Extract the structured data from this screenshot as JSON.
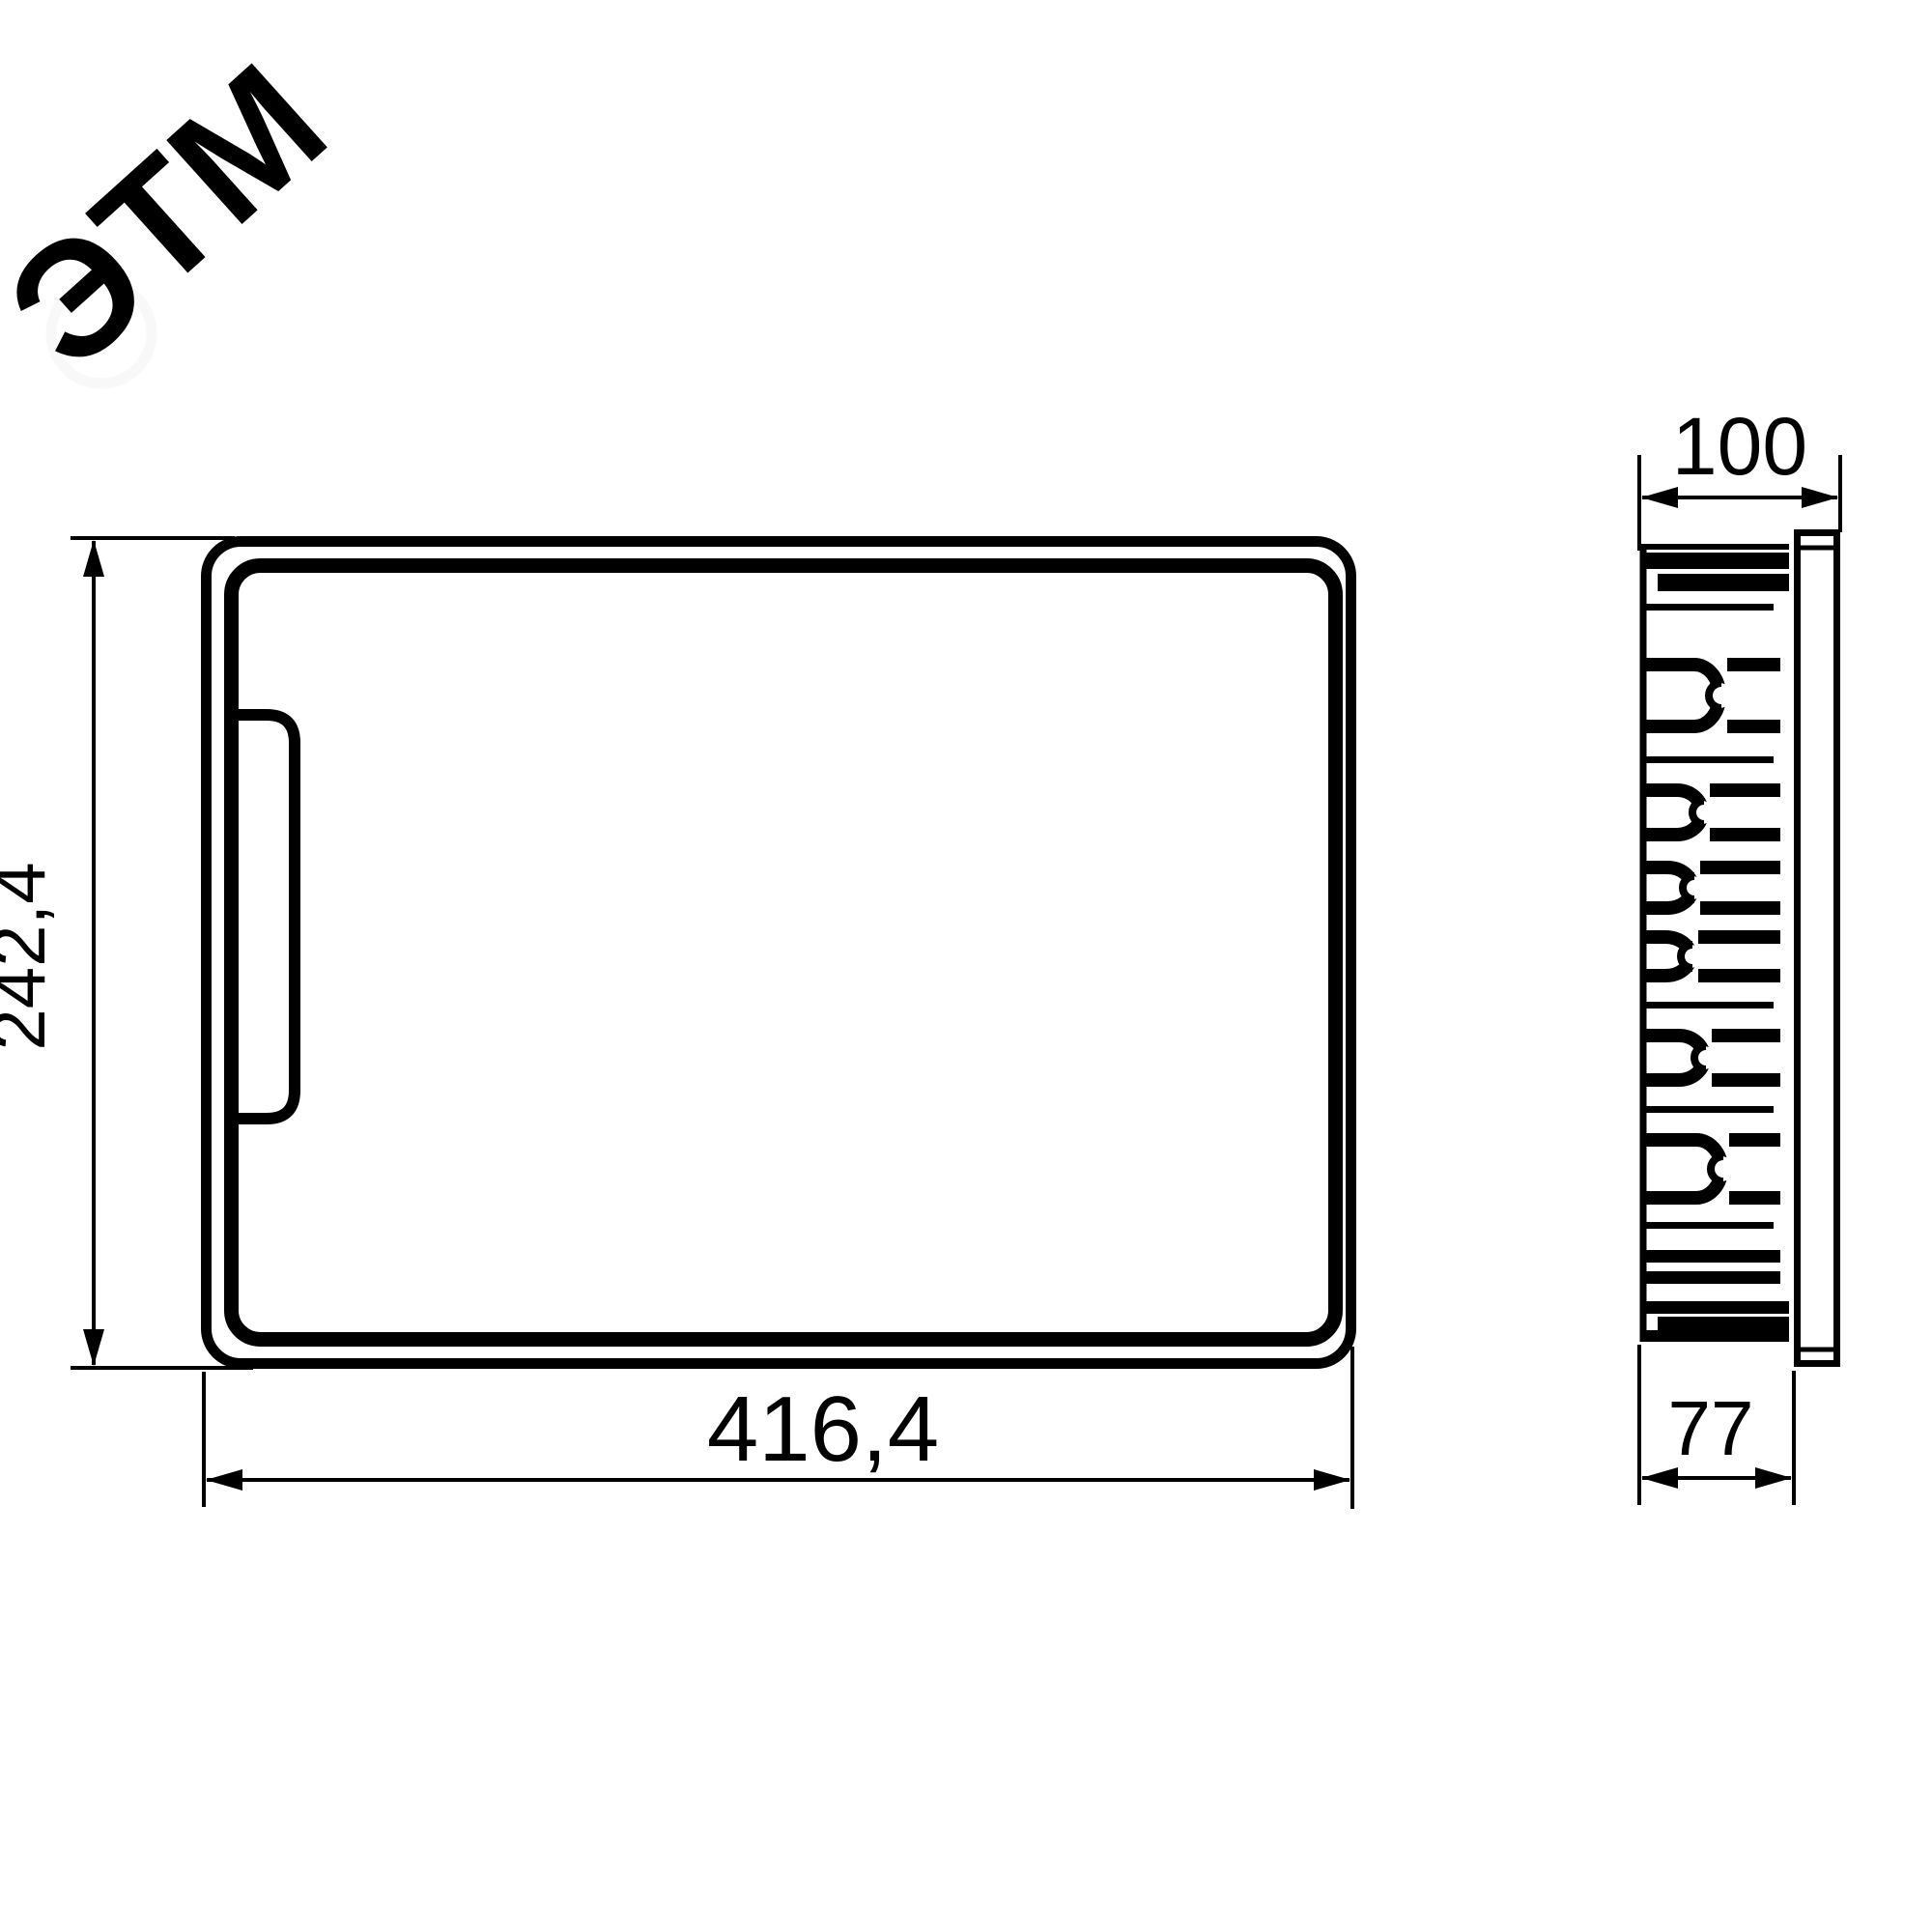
{
  "drawing": {
    "title": "flush-mount enclosure dimension drawing",
    "watermark": {
      "text": "ЭТМ"
    },
    "colors": {
      "line": "#000000",
      "background": "#ffffff",
      "watermark_text": "#f6f6f6",
      "watermark_ring": "#f8f8f8"
    },
    "views": {
      "front_view": {
        "name": "front view with door and handle",
        "dimensions": {
          "height_label": "242,4",
          "width_label": "416,4"
        }
      },
      "side_view": {
        "name": "side profile with mounting claws and front panel",
        "dimensions": {
          "depth_total_label": "100",
          "depth_body_label": "77"
        }
      }
    }
  }
}
